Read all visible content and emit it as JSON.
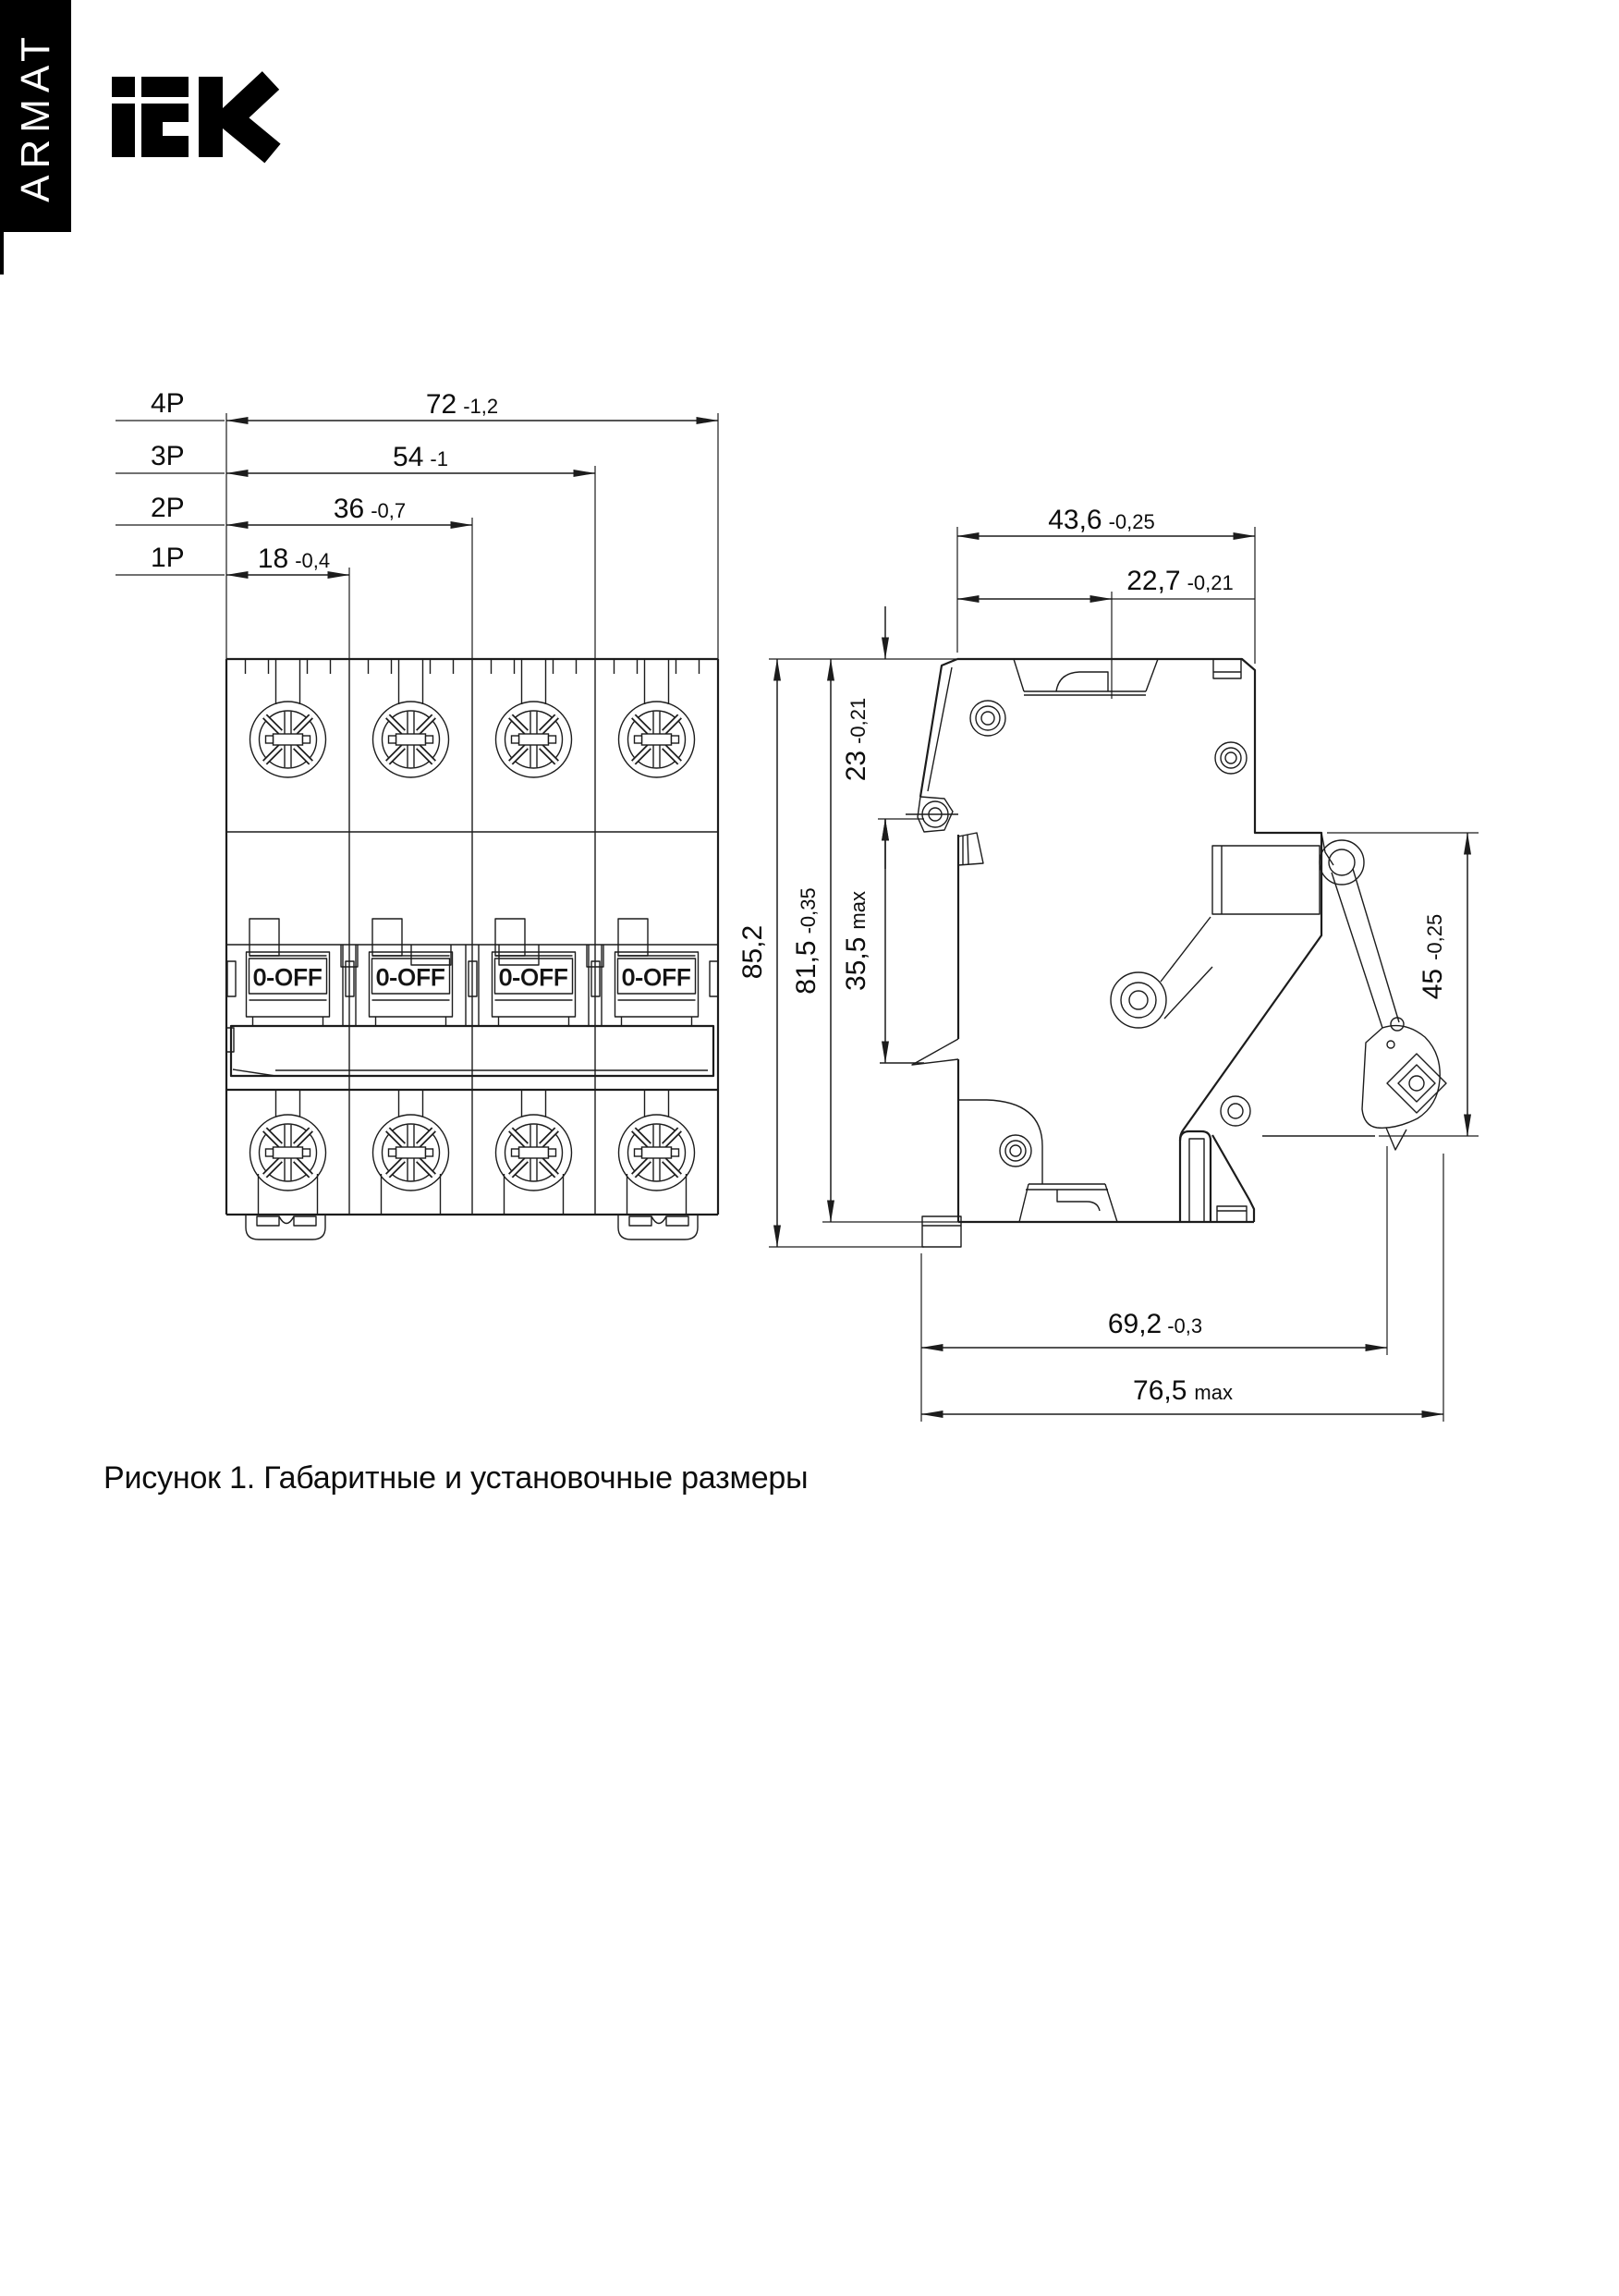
{
  "brand": {
    "sidebar_text": "ARMAT",
    "logo_name": "IEK"
  },
  "caption": "Рисунок 1. Габаритные и установочные размеры",
  "front_view": {
    "handle_label": "0-OFF",
    "pole_dims": [
      {
        "label": "4P",
        "value": "72",
        "tol": "-1,2"
      },
      {
        "label": "3P",
        "value": "54",
        "tol": "-1"
      },
      {
        "label": "2P",
        "value": "36",
        "tol": "-0,7"
      },
      {
        "label": "1P",
        "value": "18",
        "tol": "-0,4"
      }
    ]
  },
  "side_view": {
    "dims": {
      "depth_top": {
        "value": "43,6",
        "tol": "-0,25"
      },
      "handle_offset": {
        "value": "22,7",
        "tol": "-0,21"
      },
      "latch_top": {
        "value": "23",
        "tol": "-0,21"
      },
      "height_total": {
        "value": "85,2",
        "tol": ""
      },
      "height_body": {
        "value": "81,5",
        "tol": "-0,35"
      },
      "latch_travel": {
        "value": "35,5",
        "tol": "max"
      },
      "front_width": {
        "value": "45",
        "tol": "-0,25"
      },
      "depth_rail": {
        "value": "69,2",
        "tol": "-0,3"
      },
      "depth_max": {
        "value": "76,5",
        "tol": "max"
      }
    }
  }
}
